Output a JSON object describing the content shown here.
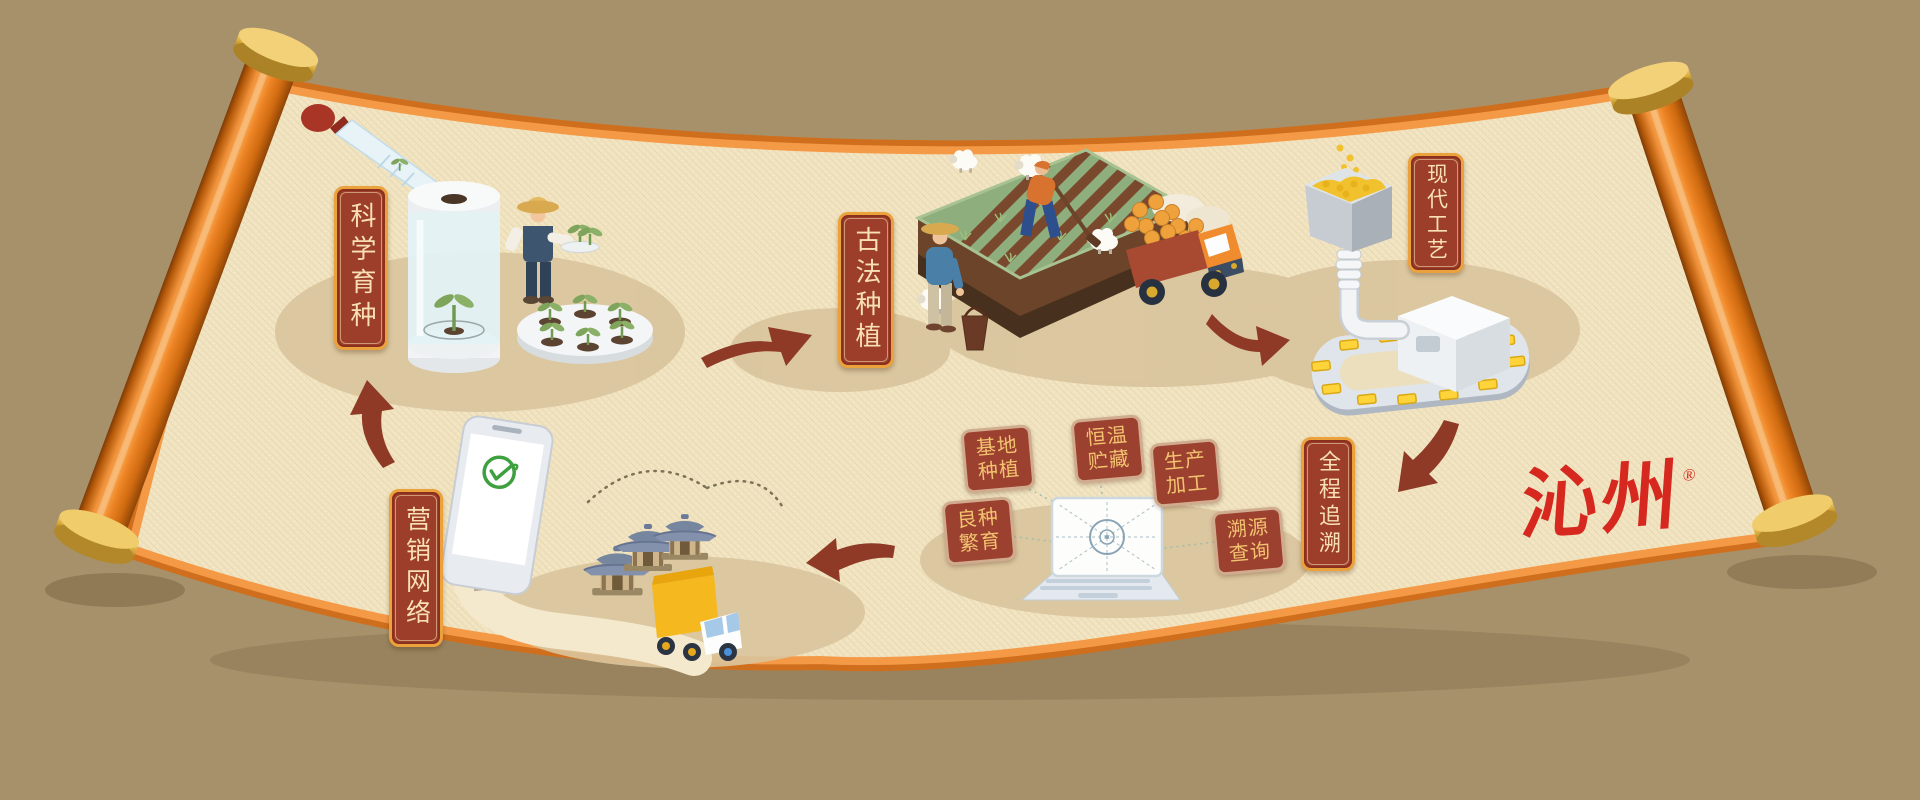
{
  "brand": {
    "name": "沁州",
    "registered": "®",
    "color": "#d6281e"
  },
  "stations": [
    {
      "id": "kexue-yuzhong",
      "label": "科学育种"
    },
    {
      "id": "gufa-zhongzhi",
      "label": "古法种植"
    },
    {
      "id": "xiandai-gongyi",
      "label": "现代工艺"
    },
    {
      "id": "quancheng-zhuisu",
      "label": "全程追溯"
    },
    {
      "id": "yingxiao-wangluo",
      "label": "营销网络"
    }
  ],
  "trace_tags": [
    {
      "id": "jidi-zhongzhi",
      "label": "基地种植"
    },
    {
      "id": "liangzhong-fanyu",
      "label": "良种繁育"
    },
    {
      "id": "hengwen-zhucang",
      "label": "恒温贮藏"
    },
    {
      "id": "shengchan-jiagong",
      "label": "生产加工"
    },
    {
      "id": "suyuan-chaxun",
      "label": "溯源查询"
    }
  ],
  "flow": [
    {
      "from": "科学育种",
      "to": "古法种植"
    },
    {
      "from": "古法种植",
      "to": "现代工艺"
    },
    {
      "from": "现代工艺",
      "to": "全程追溯"
    },
    {
      "from": "全程追溯",
      "to": "营销网络"
    },
    {
      "from": "营销网络",
      "to": "科学育种"
    }
  ],
  "icons": [
    "dropper-icon",
    "incubator-icon",
    "seedling-icon",
    "sheep-icon",
    "harvest-truck-icon",
    "hopper-icon",
    "conveyor-icon",
    "laptop-icon",
    "radar-icon",
    "check-circle-icon",
    "receipt-icon",
    "pavilion-icon",
    "delivery-truck-icon",
    "flow-arrow-icon"
  ],
  "colors": {
    "background": "#a7916a",
    "paper": "#f2e5c2",
    "scroll_edge_orange": "#e07c2c",
    "roller_orange": "#ee8526",
    "cap_gold": "#d8ab3c",
    "plaque_red": "#9c3e2a",
    "plaque_border_gold": "#eca23c",
    "plaque_text": "#f8e0b2",
    "tag_red": "#9c4030",
    "tag_text_gold": "#f2c36f",
    "arrow_red": "#8e3a26",
    "logo_red": "#d6281e",
    "check_green": "#3ea03e",
    "grain_gold": "#f2c12e",
    "field_green": "#8fae7d",
    "field_brown": "#7a482c"
  }
}
